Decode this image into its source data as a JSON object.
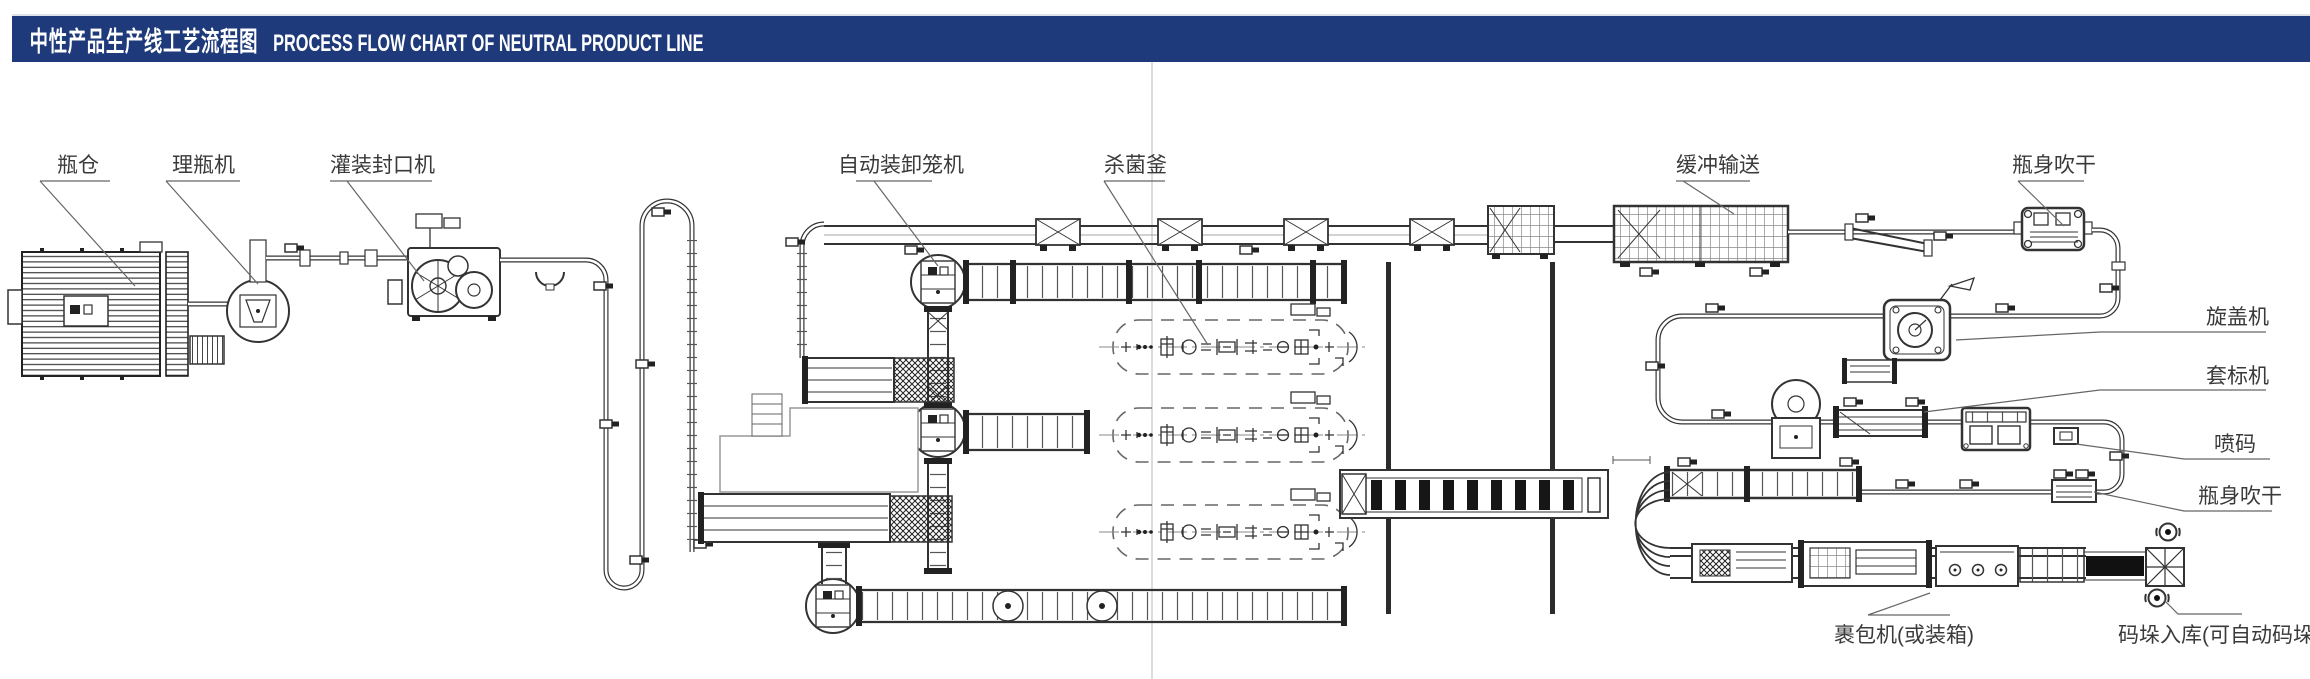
{
  "header": {
    "title_zh": "中性产品生产线工艺流程图",
    "title_en": "PROCESS FLOW CHART OF NEUTRAL PRODUCT LINE",
    "bar_color": "#1e3a7a",
    "text_color": "#ffffff"
  },
  "diagram": {
    "labels": {
      "bottle_warehouse": "瓶仓",
      "unscrambler": "理瓶机",
      "filler_sealer": "灌装封口机",
      "cage_loader": "自动装卸笼机",
      "sterilizer": "杀菌釜",
      "buffer_conveyor": "缓冲输送",
      "blow_dry_top": "瓶身吹干",
      "capping_machine": "旋盖机",
      "sleeve_labeler": "套标机",
      "inkjet_coder": "喷码",
      "blow_dry_right": "瓶身吹干",
      "wrapper": "裹包机(或装箱)",
      "palletizing": "码垛入库(可自动码垛)"
    },
    "colors": {
      "line": "#333333",
      "dark_fill": "#161616",
      "leader": "#666666",
      "fold_line": "#dcdcdc",
      "background": "#ffffff"
    }
  }
}
